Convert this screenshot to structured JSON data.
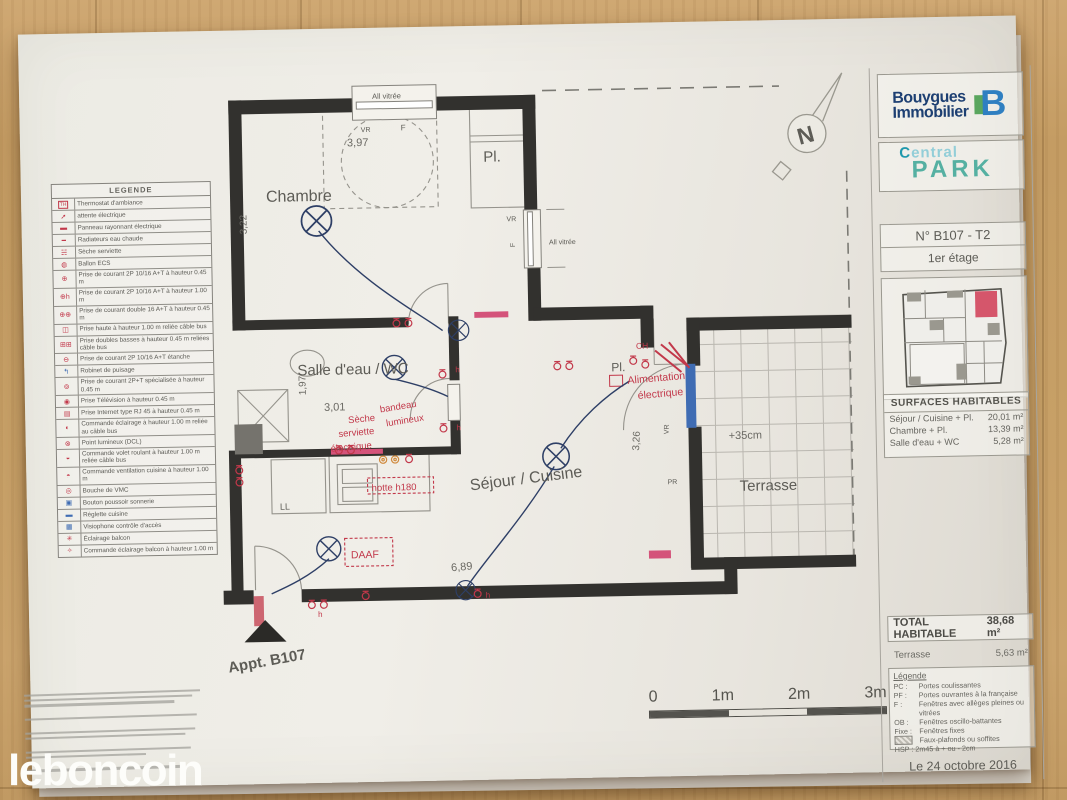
{
  "watermark": {
    "text": "leboncoin"
  },
  "brand": {
    "name_line1": "Bouygues",
    "name_line2": "Immobilier",
    "mark": "B",
    "project_word1": "Central",
    "project_word2": "PARK"
  },
  "unit_box": {
    "number": "N° B107 - T2",
    "floor": "1er étage"
  },
  "surfaces": {
    "title": "SURFACES  HABITABLES",
    "rows": [
      {
        "label": "Séjour / Cuisine + Pl.",
        "value": "20,01 m²"
      },
      {
        "label": "Chambre + Pl.",
        "value": "13,39 m²"
      },
      {
        "label": "Salle d'eau + WC",
        "value": "5,28 m²"
      }
    ],
    "total_label": "TOTAL HABITABLE",
    "total_value": "38,68 m²",
    "terrasse_label": "Terrasse",
    "terrasse_value": "5,63 m²"
  },
  "mini_legend": {
    "title": "Légende",
    "rows": [
      {
        "key": "PC :",
        "label": "Portes coulissantes"
      },
      {
        "key": "PF :",
        "label": "Portes ouvrantes à la française"
      },
      {
        "key": "F :",
        "label": "Fenêtres avec allèges pleines ou vitrées"
      },
      {
        "key": "OB :",
        "label": "Fenêtres oscillo-battantes"
      },
      {
        "key": "Fixe :",
        "label": "Fenêtres fixes"
      }
    ],
    "soffit_label": "Faux-plafonds ou soffites",
    "hsp": "HSP : 2m45 à + ou - 2cm"
  },
  "date": "Le 24 octobre 2016",
  "legend_table": {
    "title": "LEGENDE",
    "rows": [
      {
        "glyph": "TH",
        "label": "Thermostat d'ambiance"
      },
      {
        "glyph": "➚",
        "label": "attente électrique"
      },
      {
        "glyph": "▬",
        "label": "Panneau rayonnant électrique"
      },
      {
        "glyph": "━",
        "label": "Radiateurs eau chaude"
      },
      {
        "glyph": "☵",
        "label": "Sèche serviette"
      },
      {
        "glyph": "◍",
        "label": "Ballon ECS"
      },
      {
        "glyph": "⊕",
        "label": "Prise de courant 2P 10/16 A+T à hauteur 0.45 m"
      },
      {
        "glyph": "⊕h",
        "label": "Prise de courant 2P 10/16 A+T à hauteur 1.00 m"
      },
      {
        "glyph": "⊕⊕",
        "label": "Prise de courant double 16 A+T à hauteur 0.45 m"
      },
      {
        "glyph": "◫",
        "label": "Prise haute à hauteur 1.00 m reliée câble bus"
      },
      {
        "glyph": "⊞⊞",
        "label": "Prise doubles basses à hauteur 0.45 m reliées câble bus"
      },
      {
        "glyph": "⊖",
        "label": "Prise de courant 2P 10/16 A+T étanche"
      },
      {
        "glyph": "↰",
        "label": "Robinet de puisage"
      },
      {
        "glyph": "⊚",
        "label": "Prise de courant 2P+T spécialisée à hauteur 0.45 m"
      },
      {
        "glyph": "◉",
        "label": "Prise Télévision à hauteur 0.45 m"
      },
      {
        "glyph": "▤",
        "label": "Prise Internet type RJ 45 à hauteur 0.45 m"
      },
      {
        "glyph": "◐",
        "label": "Commande éclairage à hauteur 1.00 m reliée au câble bus"
      },
      {
        "glyph": "⊗",
        "label": "Point lumineux (DCL)"
      },
      {
        "glyph": "◒",
        "label": "Commande volet roulant à hauteur 1.00 m reliée câble bus"
      },
      {
        "glyph": "◓",
        "label": "Commande ventilation cuisine à hauteur 1.00 m"
      },
      {
        "glyph": "◎",
        "label": "Bouche de VMC"
      },
      {
        "glyph": "▣",
        "label": "Bouton poussoir sonnerie"
      },
      {
        "glyph": "▬",
        "label": "Réglette cuisine"
      },
      {
        "glyph": "▦",
        "label": "Visiophone contrôle d'accès"
      },
      {
        "glyph": "✳",
        "label": "Éclairage balcon"
      },
      {
        "glyph": "✧",
        "label": "Commande éclairage balcon à hauteur 1.00 m"
      }
    ]
  },
  "plan": {
    "rooms": {
      "chambre": "Chambre",
      "placard_top": "Pl.",
      "placard_mid": "Pl.",
      "salle_eau": "Salle d'eau / WC",
      "sejour": "Séjour / Cuisine",
      "terrasse": "Terrasse"
    },
    "dims": {
      "top": "3,97",
      "chambre_h": "3,22",
      "sdb_h": "1,97",
      "sdb_w": "3,01",
      "sejour_w": "6,89",
      "terrasse_h": "3,26",
      "level": "+35cm"
    },
    "ann": {
      "all_vitree": "All vitrée",
      "vr": "VR",
      "f": "F",
      "pr": "PR",
      "ch": "CH",
      "ll": "LL",
      "daaf": "DAAF",
      "hotte": "hotte h180",
      "seche1": "Sèche",
      "seche2": "serviette",
      "seche3": "électrique",
      "bandeau1": "bandeau",
      "bandeau2": "lumineux",
      "alim1": "Alimentation",
      "alim2": "électrique",
      "appt": "Appt. B107",
      "north": "N",
      "h": "h"
    },
    "scale_labels": [
      "0",
      "1m",
      "2m",
      "3m"
    ]
  },
  "colors": {
    "wall": "#32312e",
    "annotation_red": "#c2384a",
    "wiring_blue": "#2e3f66",
    "fixture_blue": "#3f6cb3",
    "brand_blue": "#1d3f72",
    "teal": "#55b0a2",
    "unit_highlight": "#d5566b",
    "wood": "#c7a067",
    "paper": "#ecebe4"
  }
}
